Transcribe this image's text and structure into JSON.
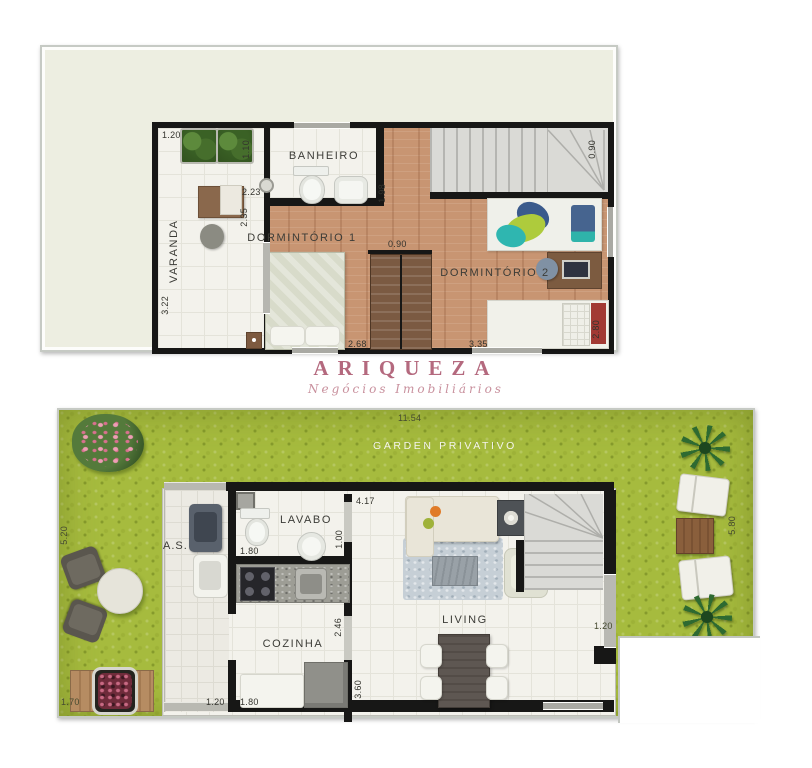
{
  "brand": {
    "name": "ARIQUEZA",
    "tagline": "Negócios Imobiliários",
    "accent_color": "#b4697e"
  },
  "upper": {
    "rooms": {
      "varanda": "VARANDA",
      "banheiro": "BANHEIRO",
      "dorm1": "DORMINTÓRIO 1",
      "dorm2": "DORMINTÓRIO 2"
    },
    "dims": {
      "varanda_w": "1.20",
      "banheiro_door": "1.10",
      "banheiro_w": "2.23",
      "dorm1_door": "2.35",
      "varanda_h": "3.22",
      "banheiro_h": "1.98",
      "closet_w": "0.90",
      "stairs_w": "0.90",
      "dorm1_w": "2.68",
      "dorm2_w": "3.35",
      "dorm2_h": "2.80"
    }
  },
  "lower": {
    "total_w": "11.54",
    "garden_label": "GARDEN PRIVATIVO",
    "rooms": {
      "as": "A.S.",
      "lavabo": "LAVABO",
      "cozinha": "COZINHA",
      "living": "LIVING"
    },
    "dims": {
      "living_w": "4.17",
      "lavabo_w": "1.80",
      "lavabo_h": "1.00",
      "cozinha_h": "2.46",
      "cozinha_w": "1.80",
      "as_w": "1.20",
      "living_h": "3.60",
      "garden_left_h": "5.20",
      "garden_left_w": "1.70",
      "garden_right_h": "5.80",
      "garden_right_w": "1.20"
    }
  },
  "colors": {
    "grass": "#a6bb3e",
    "wood_floor": "#c89572",
    "wall": "#171716",
    "panel": "#edeee1"
  }
}
